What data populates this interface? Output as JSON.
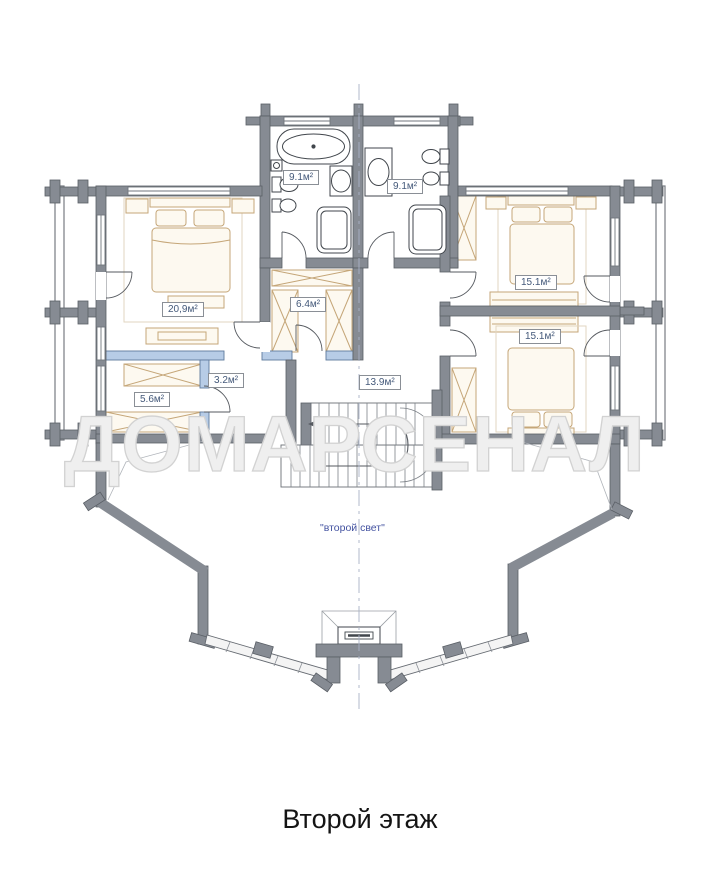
{
  "title": "Второй этаж",
  "watermark": "ДОМАРСЕНАЛ",
  "plan": {
    "rooms": [
      {
        "name": "bathroom-left",
        "area": "9.1м²"
      },
      {
        "name": "bathroom-right",
        "area": "9.1м²"
      },
      {
        "name": "bedroom-left",
        "area": "20,9м²"
      },
      {
        "name": "bedroom-right-upper",
        "area": "15.1м²"
      },
      {
        "name": "bedroom-right-lower",
        "area": "15.1м²"
      },
      {
        "name": "wardrobe-room",
        "area": "6.4м²"
      },
      {
        "name": "storage-room",
        "area": "3.2м²"
      },
      {
        "name": "dressing-room",
        "area": "5.6м²"
      },
      {
        "name": "hall",
        "area": "13.9м²"
      }
    ],
    "annotations": {
      "second_light": "\"второй свет\""
    },
    "colors": {
      "wall_gray": "#868b93",
      "partition_blue": "#b7cce6",
      "furniture_tan": "#c5a678",
      "label_text": "#44597a",
      "annotation_text": "#4352a0"
    }
  }
}
